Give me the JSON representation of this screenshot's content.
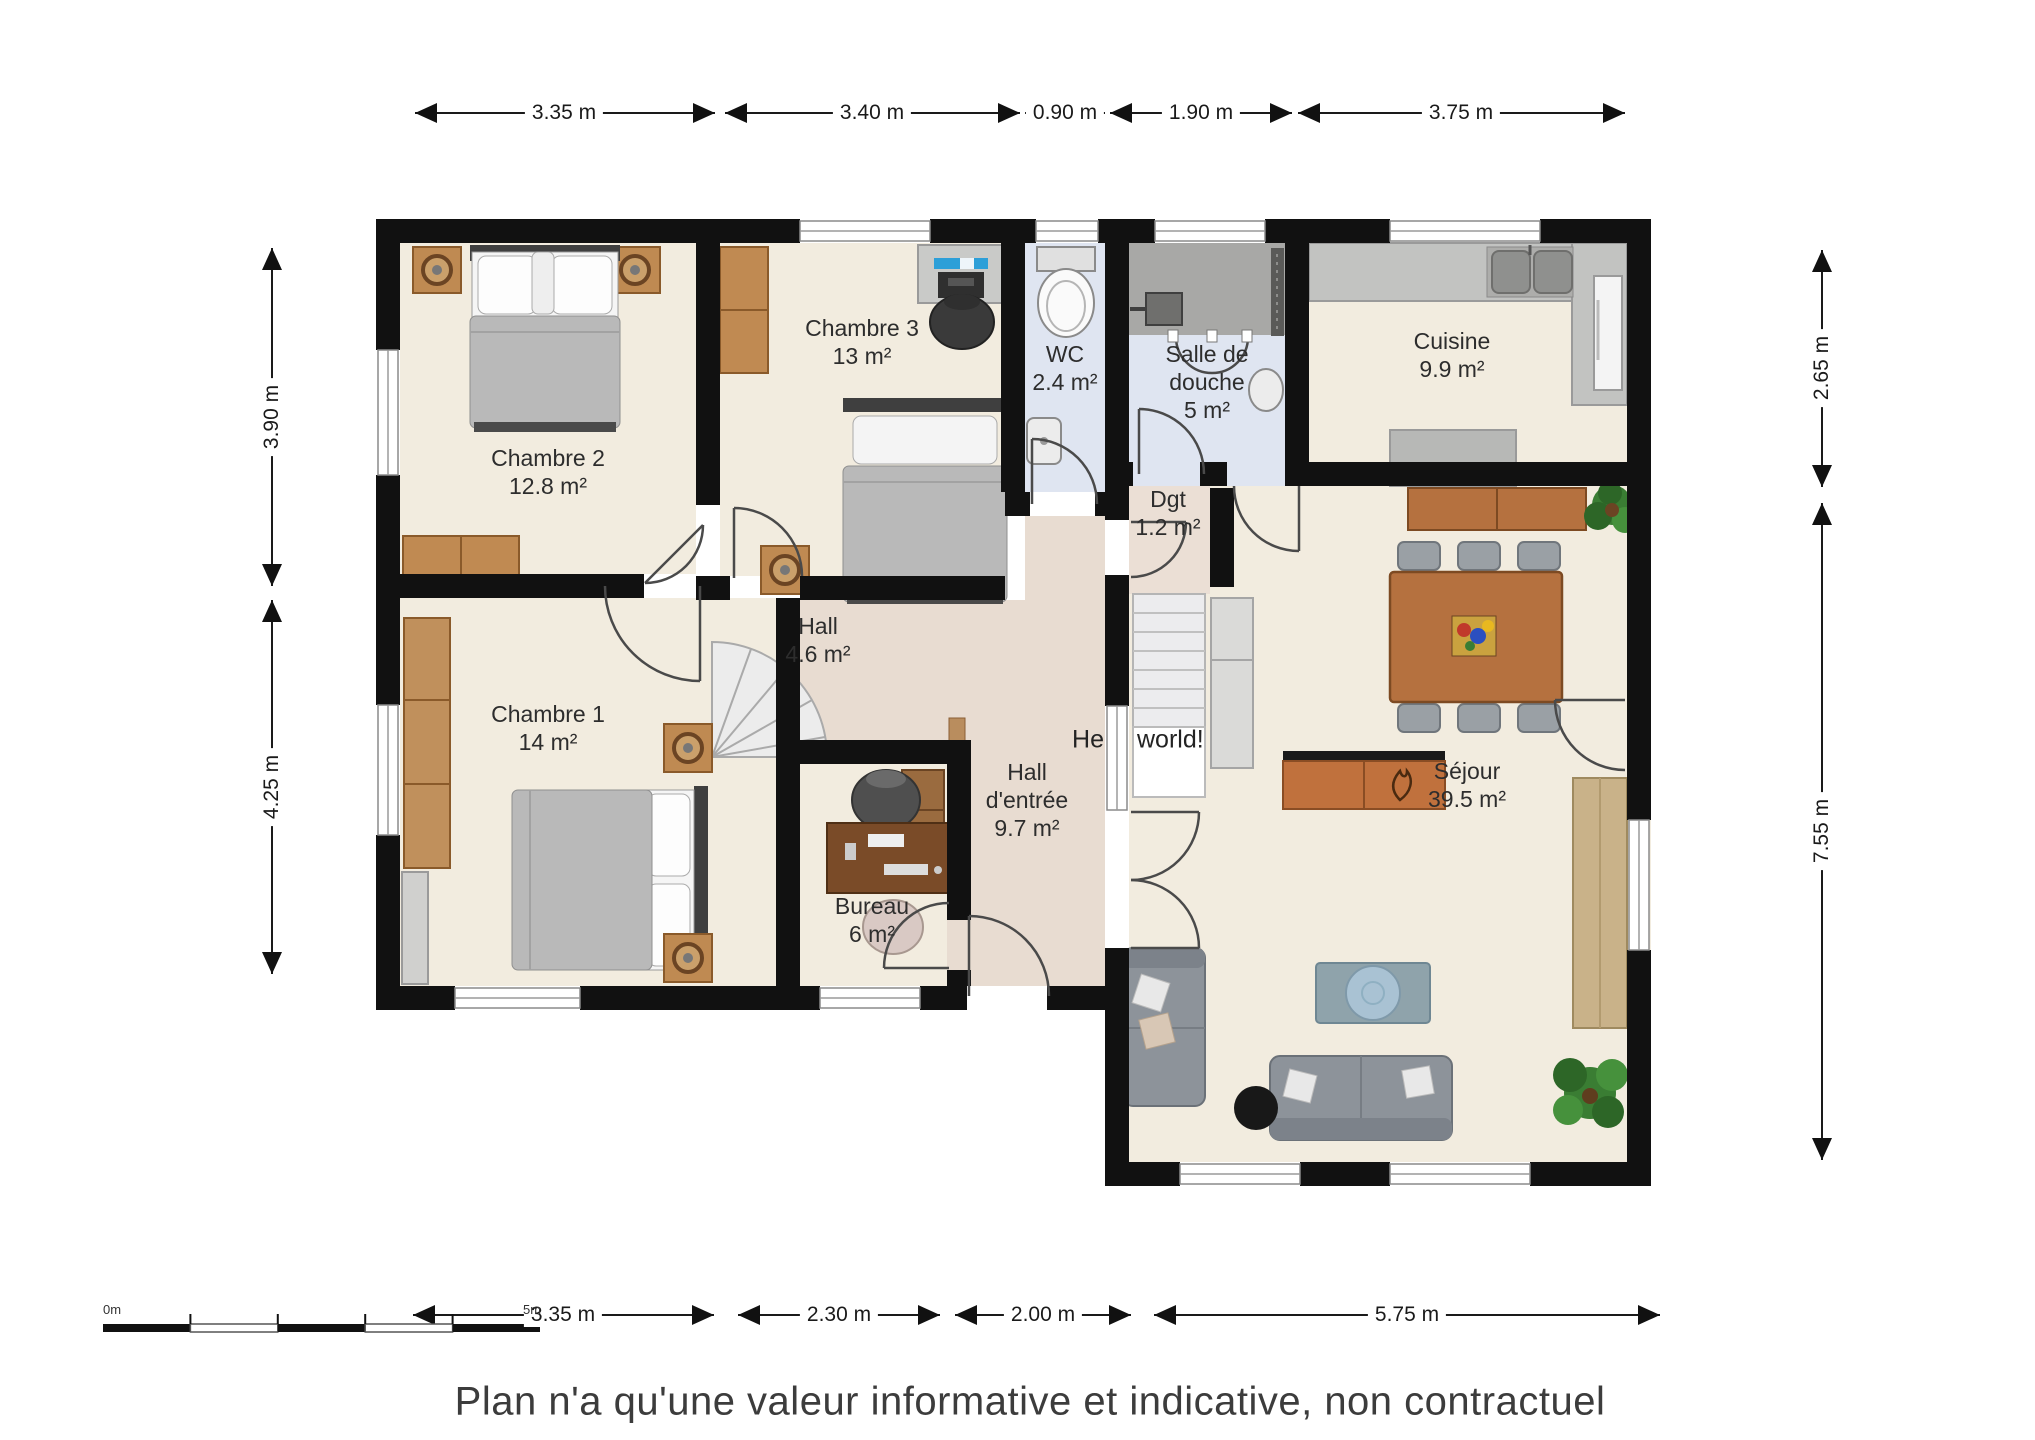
{
  "disclaimer": "Plan n'a qu'une valeur informative et indicative, non contractuel",
  "annotation": {
    "left": "He",
    "right": "world!"
  },
  "scale_bar": {
    "start": "0m",
    "end": "5m"
  },
  "rooms": {
    "chambre2": {
      "name": "Chambre 2",
      "area": "12.8 m²"
    },
    "chambre3": {
      "name": "Chambre 3",
      "area": "13 m²"
    },
    "wc": {
      "name": "WC",
      "area": "2.4 m²"
    },
    "salle_de_douche": {
      "name": "Salle de douche",
      "area": "5 m²"
    },
    "cuisine": {
      "name": "Cuisine",
      "area": "9.9 m²"
    },
    "dgt": {
      "name": "Dgt",
      "area": "1.2 m²"
    },
    "hall": {
      "name": "Hall",
      "area": "4.6 m²"
    },
    "chambre1": {
      "name": "Chambre 1",
      "area": "14 m²"
    },
    "hall_entree": {
      "name": "Hall d'entrée",
      "area": "9.7 m²"
    },
    "bureau": {
      "name": "Bureau",
      "area": "6 m²"
    },
    "sejour": {
      "name": "Séjour",
      "area": "39.5 m²"
    }
  },
  "dimensions": {
    "top": [
      "3.35 m",
      "3.40 m",
      "0.90 m",
      "1.90 m",
      "3.75 m"
    ],
    "bottom": [
      "3.35 m",
      "2.30 m",
      "2.00 m",
      "5.75 m"
    ],
    "left": [
      "3.90 m",
      "4.25 m"
    ],
    "right": [
      "2.65 m",
      "7.55 m"
    ]
  },
  "colors": {
    "wall": "#111111",
    "room_floor": "#f2ecdf",
    "hall_floor": "#e8dcd1",
    "wet_room_floor": "#dfe5f1",
    "shower_tile": "#a8a8a6",
    "wood": "#b5713f"
  }
}
